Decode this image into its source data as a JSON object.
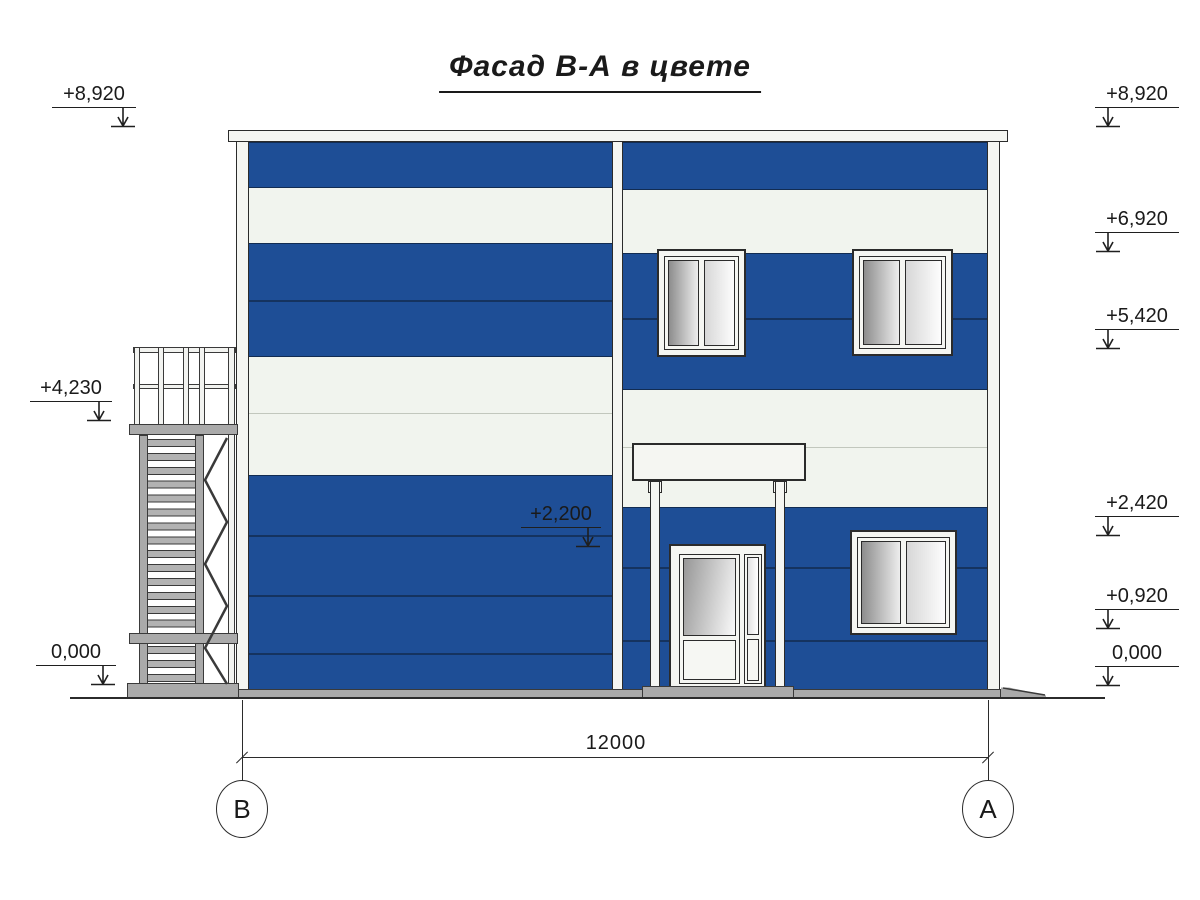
{
  "title": "Фасад В-А в цвете",
  "levels": {
    "left": [
      {
        "label": "+8,920"
      },
      {
        "label": "+4,230"
      },
      {
        "label": "0,000"
      }
    ],
    "mid": {
      "label": "+2,200"
    },
    "right": [
      {
        "label": "+8,920"
      },
      {
        "label": "+6,920"
      },
      {
        "label": "+5,420"
      },
      {
        "label": "+2,420"
      },
      {
        "label": "+0,920"
      },
      {
        "label": "0,000"
      }
    ]
  },
  "dimension": {
    "length": "12000"
  },
  "axes": {
    "left": "В",
    "right": "А"
  },
  "colors": {
    "facade_blue": "#1e4e96",
    "panel_white": "#f1f4ee",
    "frame_white": "#f5f6f2",
    "metal_gray": "#aaaaaa",
    "outline_dark": "#2b2b2b"
  }
}
